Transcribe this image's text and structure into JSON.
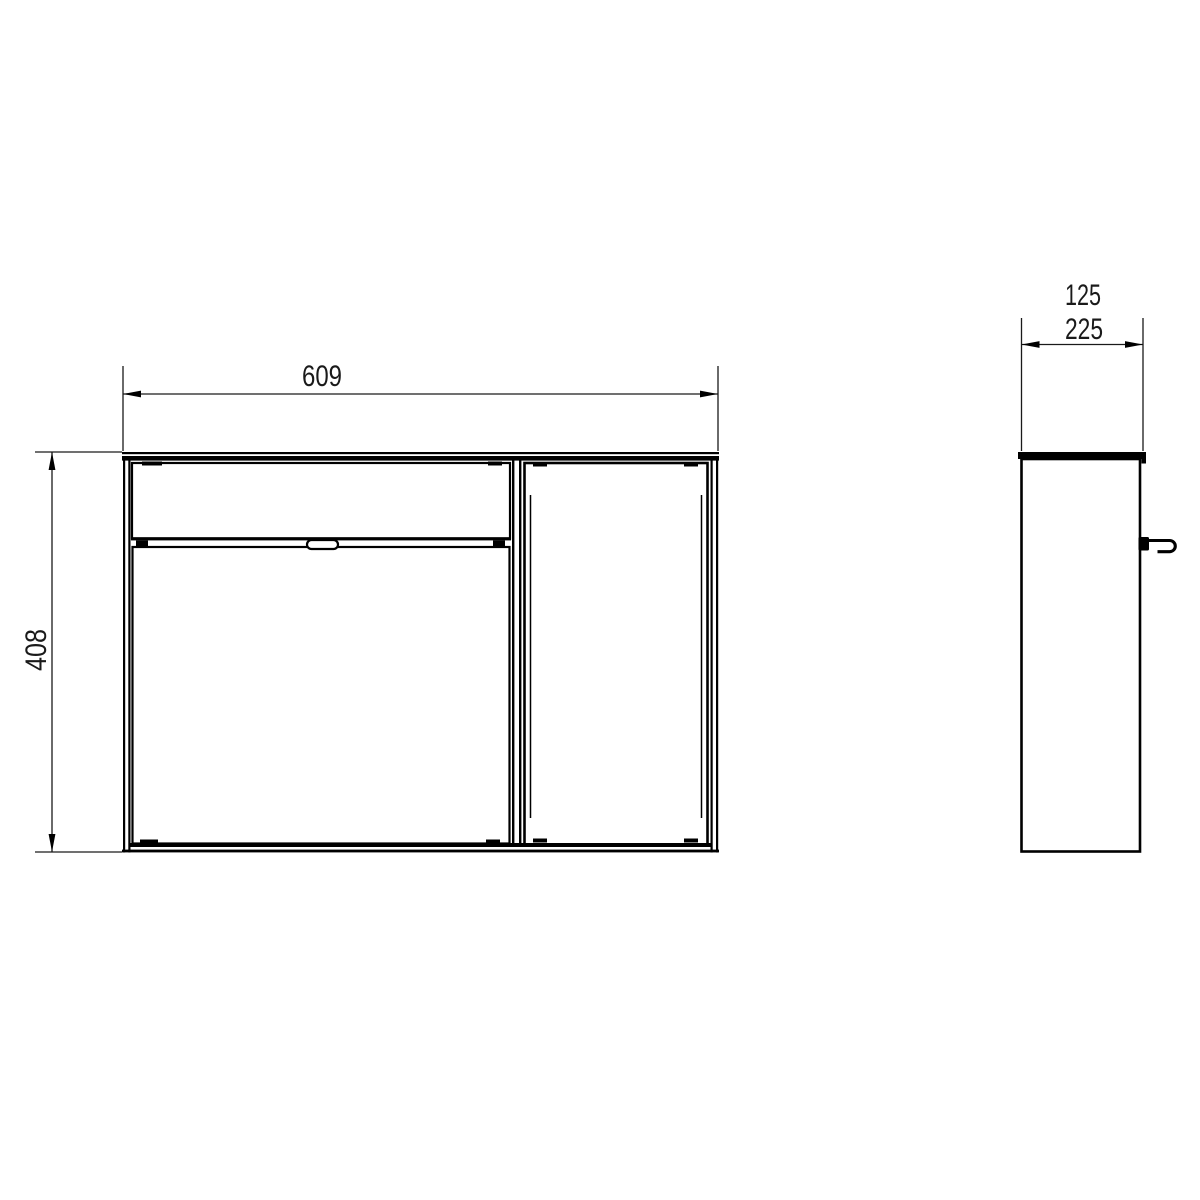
{
  "drawing": {
    "title": "cabinet-dimension-drawing",
    "dimensions": {
      "width": "609",
      "height": "408",
      "depth_upper": "125",
      "depth": "225"
    },
    "views": {
      "front": {
        "name": "front-view"
      },
      "side": {
        "name": "side-view"
      }
    },
    "colors": {
      "line": "#000000",
      "dimension_text": "#1a1a1a",
      "background": "#ffffff"
    }
  }
}
